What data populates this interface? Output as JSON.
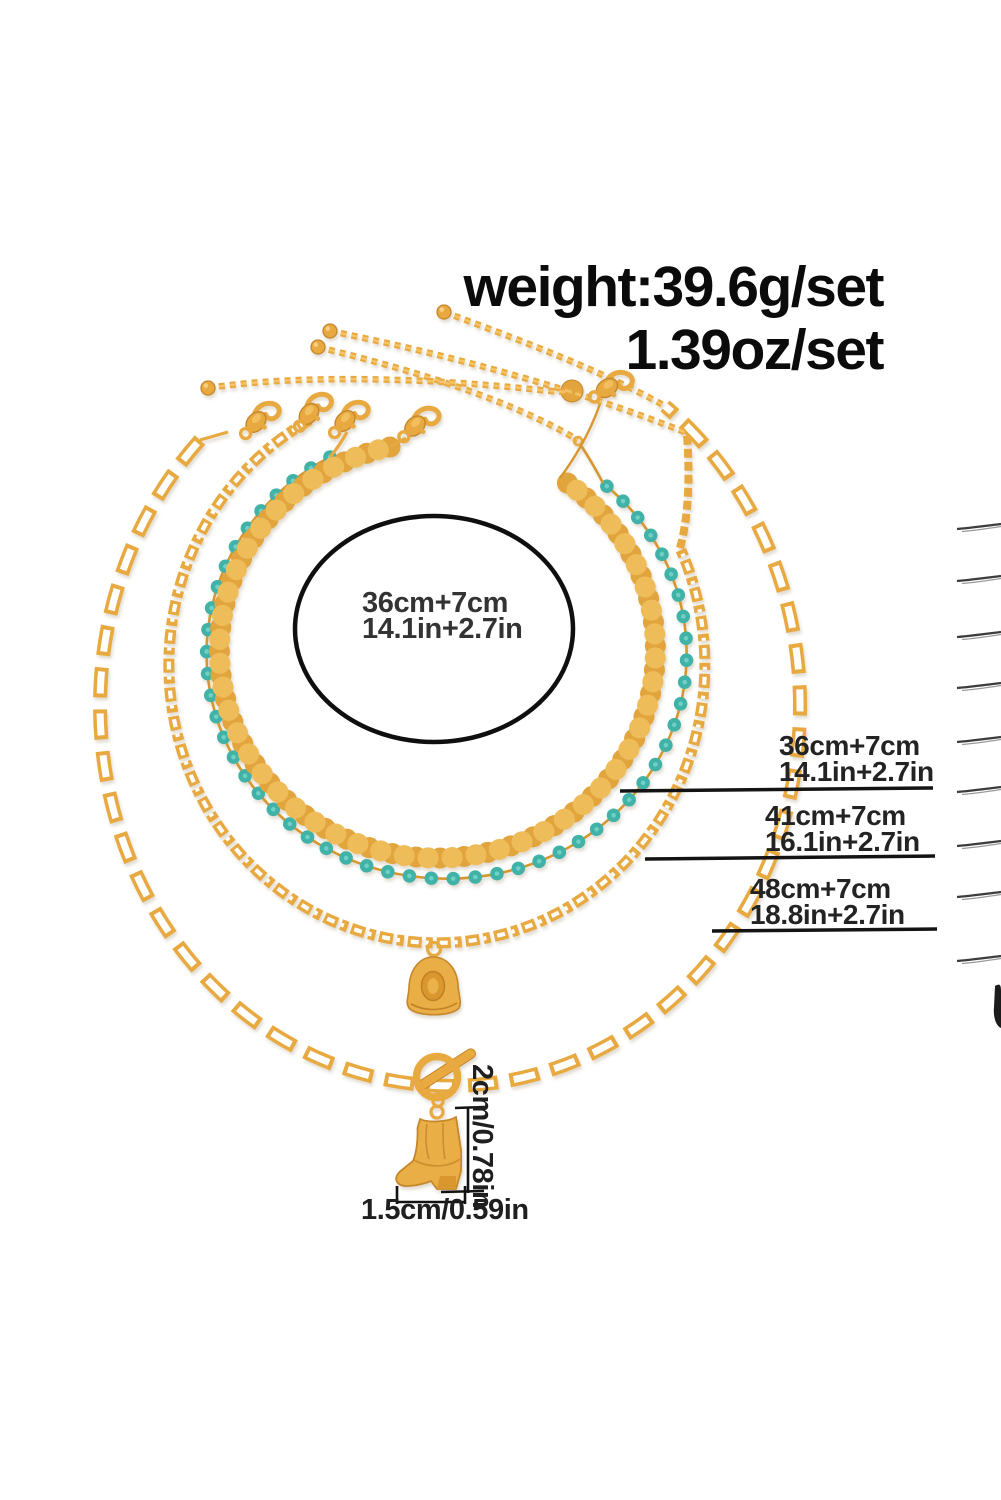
{
  "image": {
    "description": "Product measurement photo of a 4-piece layered gold western necklace set on white background",
    "background": "#ffffff"
  },
  "weight": {
    "line1": "weight:39.6g/set",
    "line2": "1.39oz/set"
  },
  "center_size": {
    "cm": "36cm+7cm",
    "inch": "14.1in+2.7in"
  },
  "chain_labels": [
    {
      "cm": "36cm+7cm",
      "inch": "14.1in+2.7in"
    },
    {
      "cm": "41cm+7cm",
      "inch": "16.1in+2.7in"
    },
    {
      "cm": "48cm+7cm",
      "inch": "18.8in+2.7in"
    }
  ],
  "pendant_dims": {
    "height": "2cm/0.78in",
    "width": "1.5cm/0.59in"
  },
  "necklaces": [
    {
      "name": "gold-disc-sequin-choker",
      "length": "36cm+7cm"
    },
    {
      "name": "turquoise-bead-chain",
      "length": "36cm+7cm"
    },
    {
      "name": "figaro-chain-with-cowboy-hat-pendant",
      "length": "41cm+7cm"
    },
    {
      "name": "paperclip-chain-with-toggle-and-cowboy-boot-pendant",
      "length": "48cm+7cm"
    }
  ],
  "colors": {
    "gold": "#E7A93F",
    "gold_light": "#F5C468",
    "gold_dark": "#C6872B",
    "turquoise": "#3FB2A7",
    "ink": "#131313",
    "edge_mark": "#3c3c3c"
  }
}
